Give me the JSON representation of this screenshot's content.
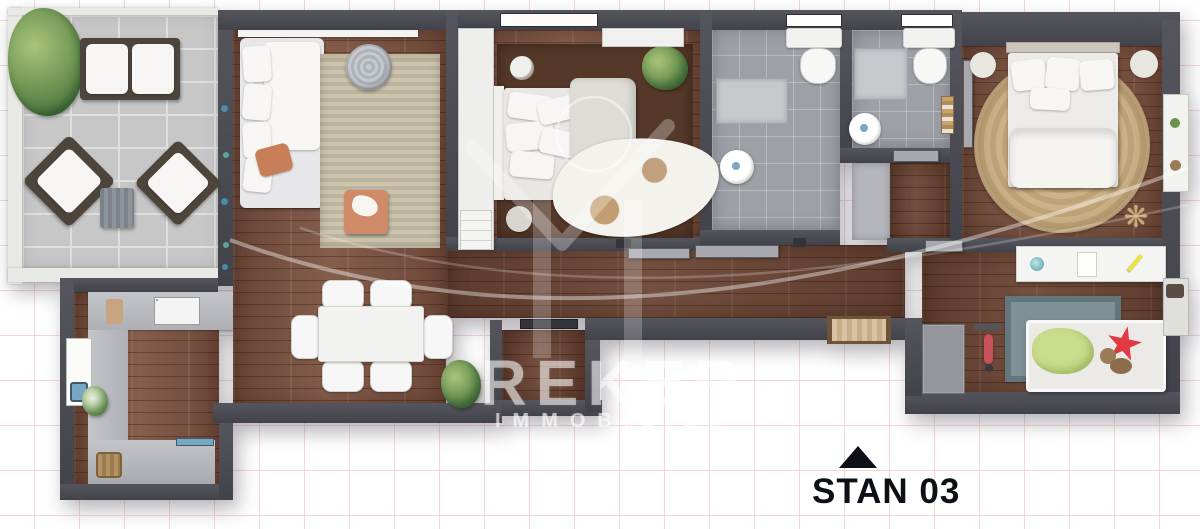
{
  "canvas": {
    "width_px": 1200,
    "height_px": 529,
    "background": "#ffffff",
    "grid_color": "#f3d7d7",
    "grid_size_px": 45
  },
  "watermark": {
    "brand": "REKER",
    "subtitle": "IMMOBILIEN",
    "logo": "house-emblem-with-circle-and-swoosh",
    "color": "rgba(255,255,255,0.5)"
  },
  "unit_label": {
    "text": "STAN 03",
    "marker_icon": "triangle-up-icon",
    "text_color": "#0d1016",
    "marker_color": "#0d0d10"
  },
  "glyphs": {
    "dried_plant": "❋"
  },
  "palette": {
    "wall": "#42424b",
    "wood_floor": "#7d5341",
    "terrace_tile": "#c7c7c8",
    "bath_tile": "#9da0a6",
    "grid_color": "#f3d7d7",
    "rug_beige": "#c9c0a6",
    "rug_jute": "#cdb289",
    "rug_teal": "#7d9197",
    "accent_orange": "#c87e58",
    "star_red": "#e23a44",
    "blanket_green": "#c9dc8c",
    "plant_green": "#6a9150",
    "sink_blue": "#79a8c4",
    "label_color": "#0d1016"
  },
  "rooms": [
    {
      "name": "terrace"
    },
    {
      "name": "living-room"
    },
    {
      "name": "dining-area"
    },
    {
      "name": "kitchen"
    },
    {
      "name": "bedroom-middle"
    },
    {
      "name": "bathroom-1"
    },
    {
      "name": "bathroom-2"
    },
    {
      "name": "hallway"
    },
    {
      "name": "entry"
    },
    {
      "name": "bedroom-master"
    },
    {
      "name": "kids-room"
    }
  ]
}
